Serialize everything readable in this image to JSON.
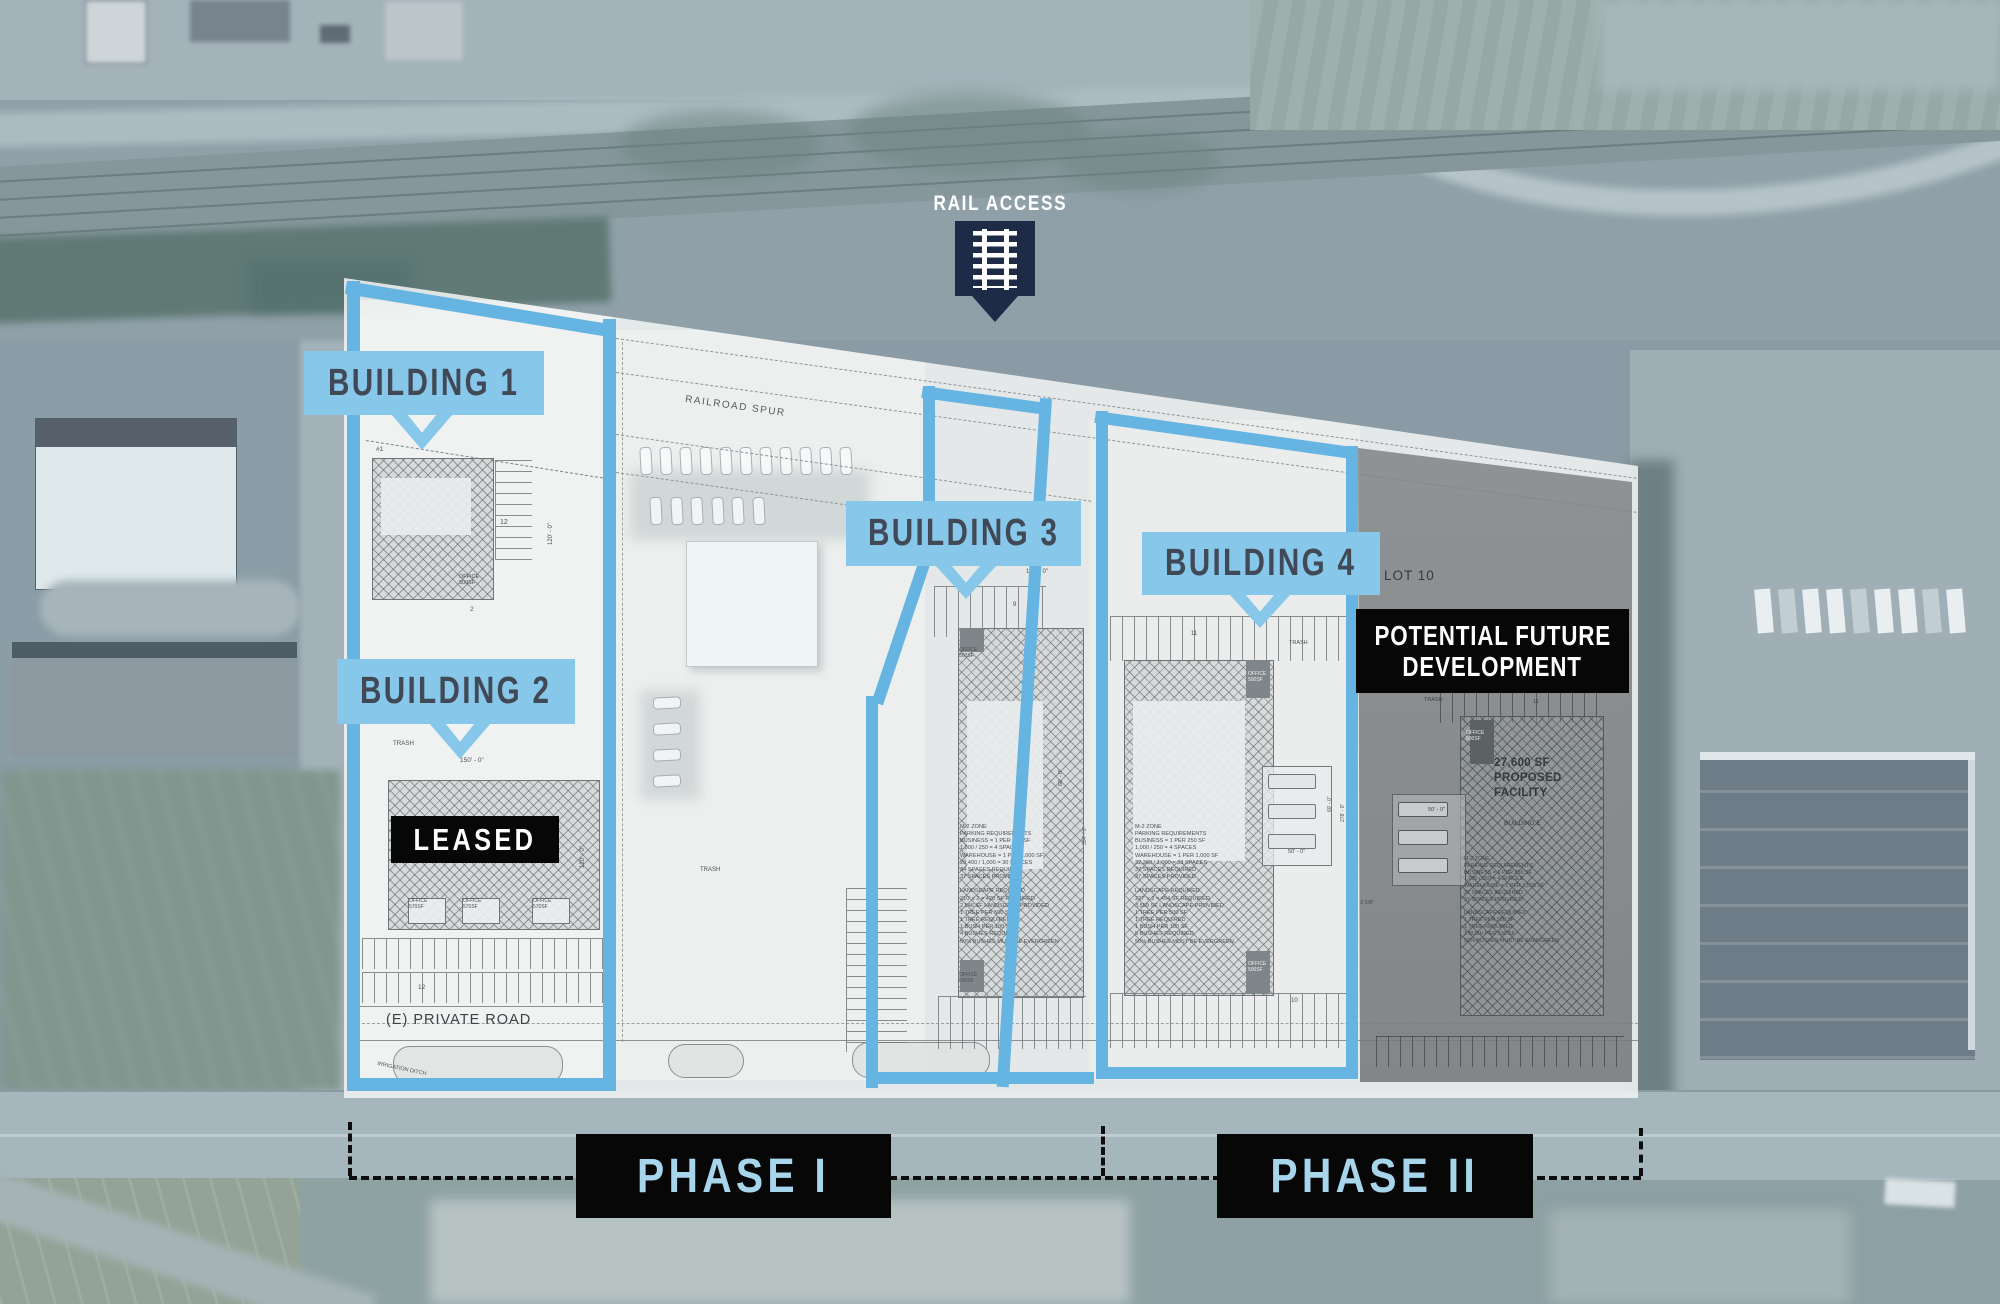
{
  "rail_access": {
    "label": "RAIL ACCESS"
  },
  "callouts": [
    {
      "label": "BUILDING 1"
    },
    {
      "label": "BUILDING 2"
    },
    {
      "label": "BUILDING 3"
    },
    {
      "label": "BUILDING 4"
    }
  ],
  "overlays": {
    "leased": "LEASED",
    "potential_future_line1": "POTENTIAL FUTURE",
    "potential_future_line2": "DEVELOPMENT",
    "lot_label": "LOT 10",
    "proposed_facility": "27,600 SF\nPROPOSED\nFACILITY",
    "building_e": "BUILDING E"
  },
  "phases": [
    {
      "label": "PHASE I"
    },
    {
      "label": "PHASE II"
    }
  ],
  "colors": {
    "callout_blue": "#87c7ea",
    "parcel_outline_blue": "#66b4e2",
    "marker_navy": "#1d2b47",
    "badge_black": "#070707",
    "phase_text_blue": "#a7d5ec",
    "plan_text_gray": "#4a4f53"
  },
  "plan": {
    "labels": [
      {
        "text": "RAILROAD SPUR",
        "x": 686,
        "y": 394,
        "s": 10,
        "rot": 8,
        "ls": 1.5,
        "c": "#565b5e"
      },
      {
        "text": "#1",
        "x": 376,
        "y": 446,
        "s": 6.5
      },
      {
        "text": "12",
        "x": 500,
        "y": 519,
        "s": 7
      },
      {
        "text": "120' - 0\"",
        "x": 548,
        "y": 545,
        "s": 6,
        "rot": -90
      },
      {
        "text": "OFFICE\n500SF",
        "x": 459,
        "y": 574,
        "s": 5.5,
        "lh": 1.15
      },
      {
        "text": "2",
        "x": 470,
        "y": 606,
        "s": 6.5
      },
      {
        "text": "TRASH",
        "x": 393,
        "y": 740,
        "s": 6.2
      },
      {
        "text": "150' - 0\"",
        "x": 460,
        "y": 757,
        "s": 6.5
      },
      {
        "text": "24' - 0\"",
        "x": 354,
        "y": 888,
        "s": 5.5,
        "rot": -90
      },
      {
        "text": "OFFICE\n570SF",
        "x": 409,
        "y": 899,
        "s": 5,
        "lh": 1.15
      },
      {
        "text": "OFFICE\n570SF",
        "x": 463,
        "y": 899,
        "s": 5,
        "lh": 1.15
      },
      {
        "text": "OFFICE\n570SF",
        "x": 533,
        "y": 899,
        "s": 5,
        "lh": 1.15
      },
      {
        "text": "120' - 0\"",
        "x": 580,
        "y": 868,
        "s": 6,
        "rot": -90
      },
      {
        "text": "12",
        "x": 418,
        "y": 984,
        "s": 6.5
      },
      {
        "text": "(E) PRIVATE ROAD",
        "x": 386,
        "y": 1012,
        "s": 14.5,
        "c": "#3b4145",
        "ls": 1
      },
      {
        "text": "IRRIGATION DITCH",
        "x": 378,
        "y": 1061,
        "s": 5.5,
        "rot": 12,
        "c": "#51565a"
      },
      {
        "text": "TRASH",
        "x": 700,
        "y": 867,
        "s": 6
      },
      {
        "text": "10",
        "x": 866,
        "y": 963,
        "s": 6
      },
      {
        "text": "140' - 0\"",
        "x": 1026,
        "y": 569,
        "s": 6
      },
      {
        "text": "9",
        "x": 1013,
        "y": 602,
        "s": 6
      },
      {
        "text": "OFFICE\n500SF",
        "x": 959,
        "y": 648,
        "s": 5,
        "lh": 1.15
      },
      {
        "text": "66' - 0\"",
        "x": 1058,
        "y": 786,
        "s": 5.5,
        "rot": -90
      },
      {
        "text": "M-2 ZONE\nPARKING REQUIREMENTS\nBUSINESS = 1 PER 250 SF\n 1,000 / 250 = 4 SPACES\nWAREHOUSE = 1 PER 1,000 SF\n 29,400 / 1,000 = 30 SPACES\n34 SPACES REQUIRED\n37 SPACES PROVIDED\n \nLANDSCAPE REQUIRED\n210' x 2 = 420 SF REQUIRED\n2,546 SF LANDSCAPE PROVIDED\n1 TREE PER 500 SF\n1 TREE REQUIRED\n1 BUSH PER 100 SF\n4 BUSHES REQUIRED\n50% BUSHES MUST BE EVERGREEN",
        "x": 960,
        "y": 824,
        "s": 5.6,
        "lh": 1.28
      },
      {
        "text": "OFFICE\n500SF",
        "x": 959,
        "y": 973,
        "s": 5,
        "lh": 1.15
      },
      {
        "text": "10",
        "x": 1003,
        "y": 1013,
        "s": 6
      },
      {
        "text": "304' - 0\"",
        "x": 1082,
        "y": 845,
        "s": 5,
        "rot": -90,
        "c": "#60656a"
      },
      {
        "text": "11",
        "x": 1191,
        "y": 631,
        "s": 6
      },
      {
        "text": "TRASH",
        "x": 1289,
        "y": 640,
        "s": 5.5
      },
      {
        "text": "OFFICE\n500SF",
        "x": 1248,
        "y": 672,
        "s": 5,
        "c": "#eef1f2",
        "lh": 1.15
      },
      {
        "text": "M-2 ZONE\nPARKING REQUIREMENTS\nBUSINESS = 1 PER 250 SF\n 1,000 / 250 = 4 SPACES\nWAREHOUSE = 1 PER 1,000 SF\n 32,360 / 1,000 = 33 SPACES\n37 SPACES REQUIRED\n37 SPACES PROVIDED\n \nLANDSCAPE REQUIRED\n227' x 2 = 454 SF REQUIRED\n3,559 SF LANDSCAPE PROVIDED\n1 TREE PER 500 SF\n1 TREE REQUIRED\n1 BUSH PER 100 SF\n5 BUSHES REQUIRED\n50% BUSHES MUST BE EVERGREEN",
        "x": 1135,
        "y": 824,
        "s": 5.6,
        "lh": 1.28
      },
      {
        "text": "50' - 0\"",
        "x": 1288,
        "y": 849,
        "s": 5.5
      },
      {
        "text": "60' - 0\"",
        "x": 1327,
        "y": 812,
        "s": 5,
        "rot": -90
      },
      {
        "text": "278' - 0\"",
        "x": 1340,
        "y": 822,
        "s": 5,
        "rot": -90
      },
      {
        "text": "OFFICE\n500SF",
        "x": 1248,
        "y": 962,
        "s": 5,
        "c": "#eef1f2",
        "lh": 1.15
      },
      {
        "text": "10",
        "x": 1291,
        "y": 998,
        "s": 6
      },
      {
        "text": "63' - 3 5/8\"",
        "x": 1348,
        "y": 900,
        "s": 5.5
      },
      {
        "text": "TRASH",
        "x": 1424,
        "y": 697,
        "s": 5.5,
        "c": "#3d4246"
      },
      {
        "text": "11",
        "x": 1533,
        "y": 699,
        "s": 5.5,
        "c": "#3d4246"
      },
      {
        "text": "OFFICE\n500SF",
        "x": 1466,
        "y": 731,
        "s": 5,
        "c": "#e8eaeb",
        "lh": 1.15
      },
      {
        "text": "50' - 0\"",
        "x": 1428,
        "y": 807,
        "s": 5.5,
        "c": "#3d4246"
      },
      {
        "text": "M-2 ZONE\nPARKING REQUIREMENTS\nBUSINESS = 1 PER 250 SF\n 1,000 / 250 = 4 SPACES\nWAREHOUSE = 1 PER 1,000 SF\n37 SPACES REQUIRED\n37 SPACES PROVIDED\n \nLANDSCAPE REQUIRED\n1 TREE PER 500 SF\n1 TREE REQUIRED\n1 BUSH PER 100 SF\n50% BUSHES MUST BE EVERGREEN",
        "x": 1464,
        "y": 856,
        "s": 5.4,
        "lh": 1.26,
        "c": "#42474a"
      }
    ]
  }
}
